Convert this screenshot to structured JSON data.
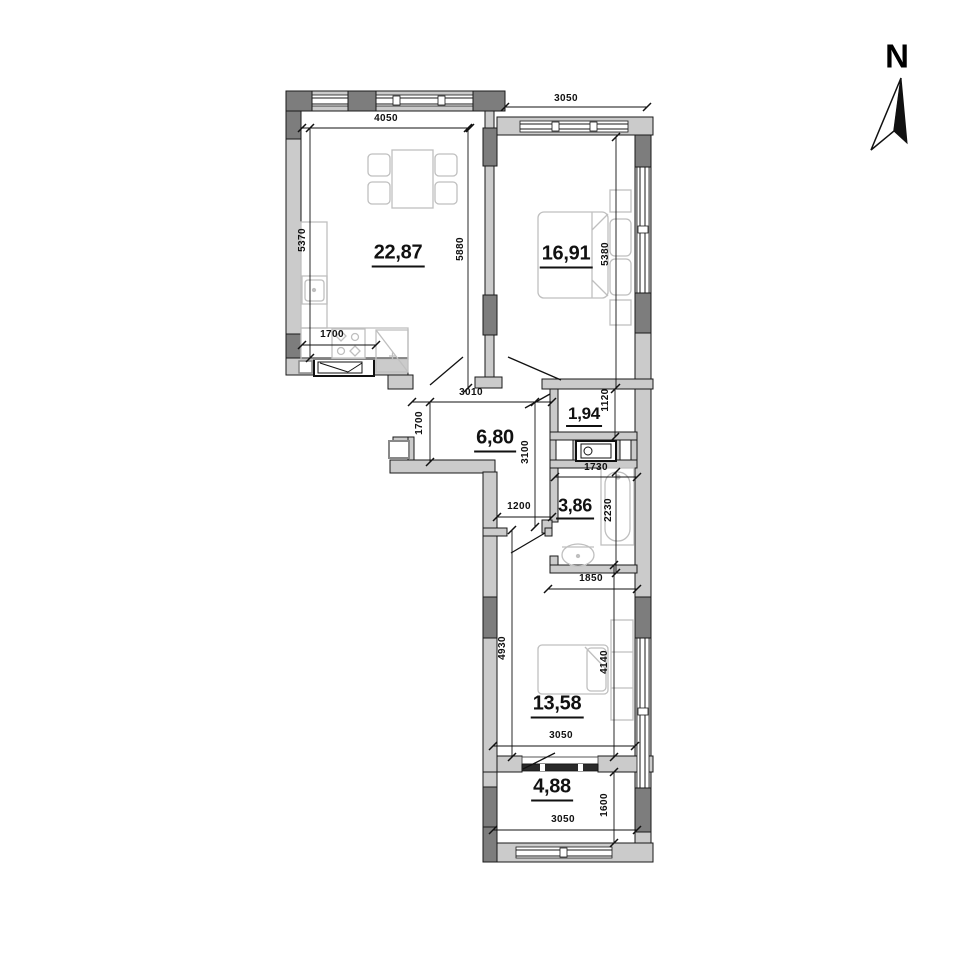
{
  "north": {
    "label": "N"
  },
  "rooms": {
    "living": {
      "area": "22,87"
    },
    "bedroom1": {
      "area": "16,91"
    },
    "hall": {
      "area": "6,80"
    },
    "closet": {
      "area": "1,94"
    },
    "bathroom": {
      "area": "3,86"
    },
    "bedroom2": {
      "area": "13,58"
    },
    "balcony": {
      "area": "4,88"
    }
  },
  "dims": {
    "living_top": "4050",
    "bedroom1_top": "3050",
    "living_left": "5370",
    "living_right": "5880",
    "bedroom1_right": "5380",
    "kitchen_front": "1700",
    "hall_top": "3010",
    "hall_left": "1700",
    "hall_mid": "3100",
    "closet_right": "1120",
    "bath_top": "1730",
    "bath_right": "2230",
    "hall_lower": "1200",
    "bath_bottom": "1850",
    "bedroom2_left": "4930",
    "bedroom2_right": "4140",
    "bedroom2_bottom": "3050",
    "balcony_right": "1600",
    "balcony_bottom": "3050"
  },
  "colors": {
    "wall": "#cbcbcb",
    "pier": "#7d7d7d",
    "line": "#1a1a1a",
    "furniture": "#bfbfbf"
  }
}
